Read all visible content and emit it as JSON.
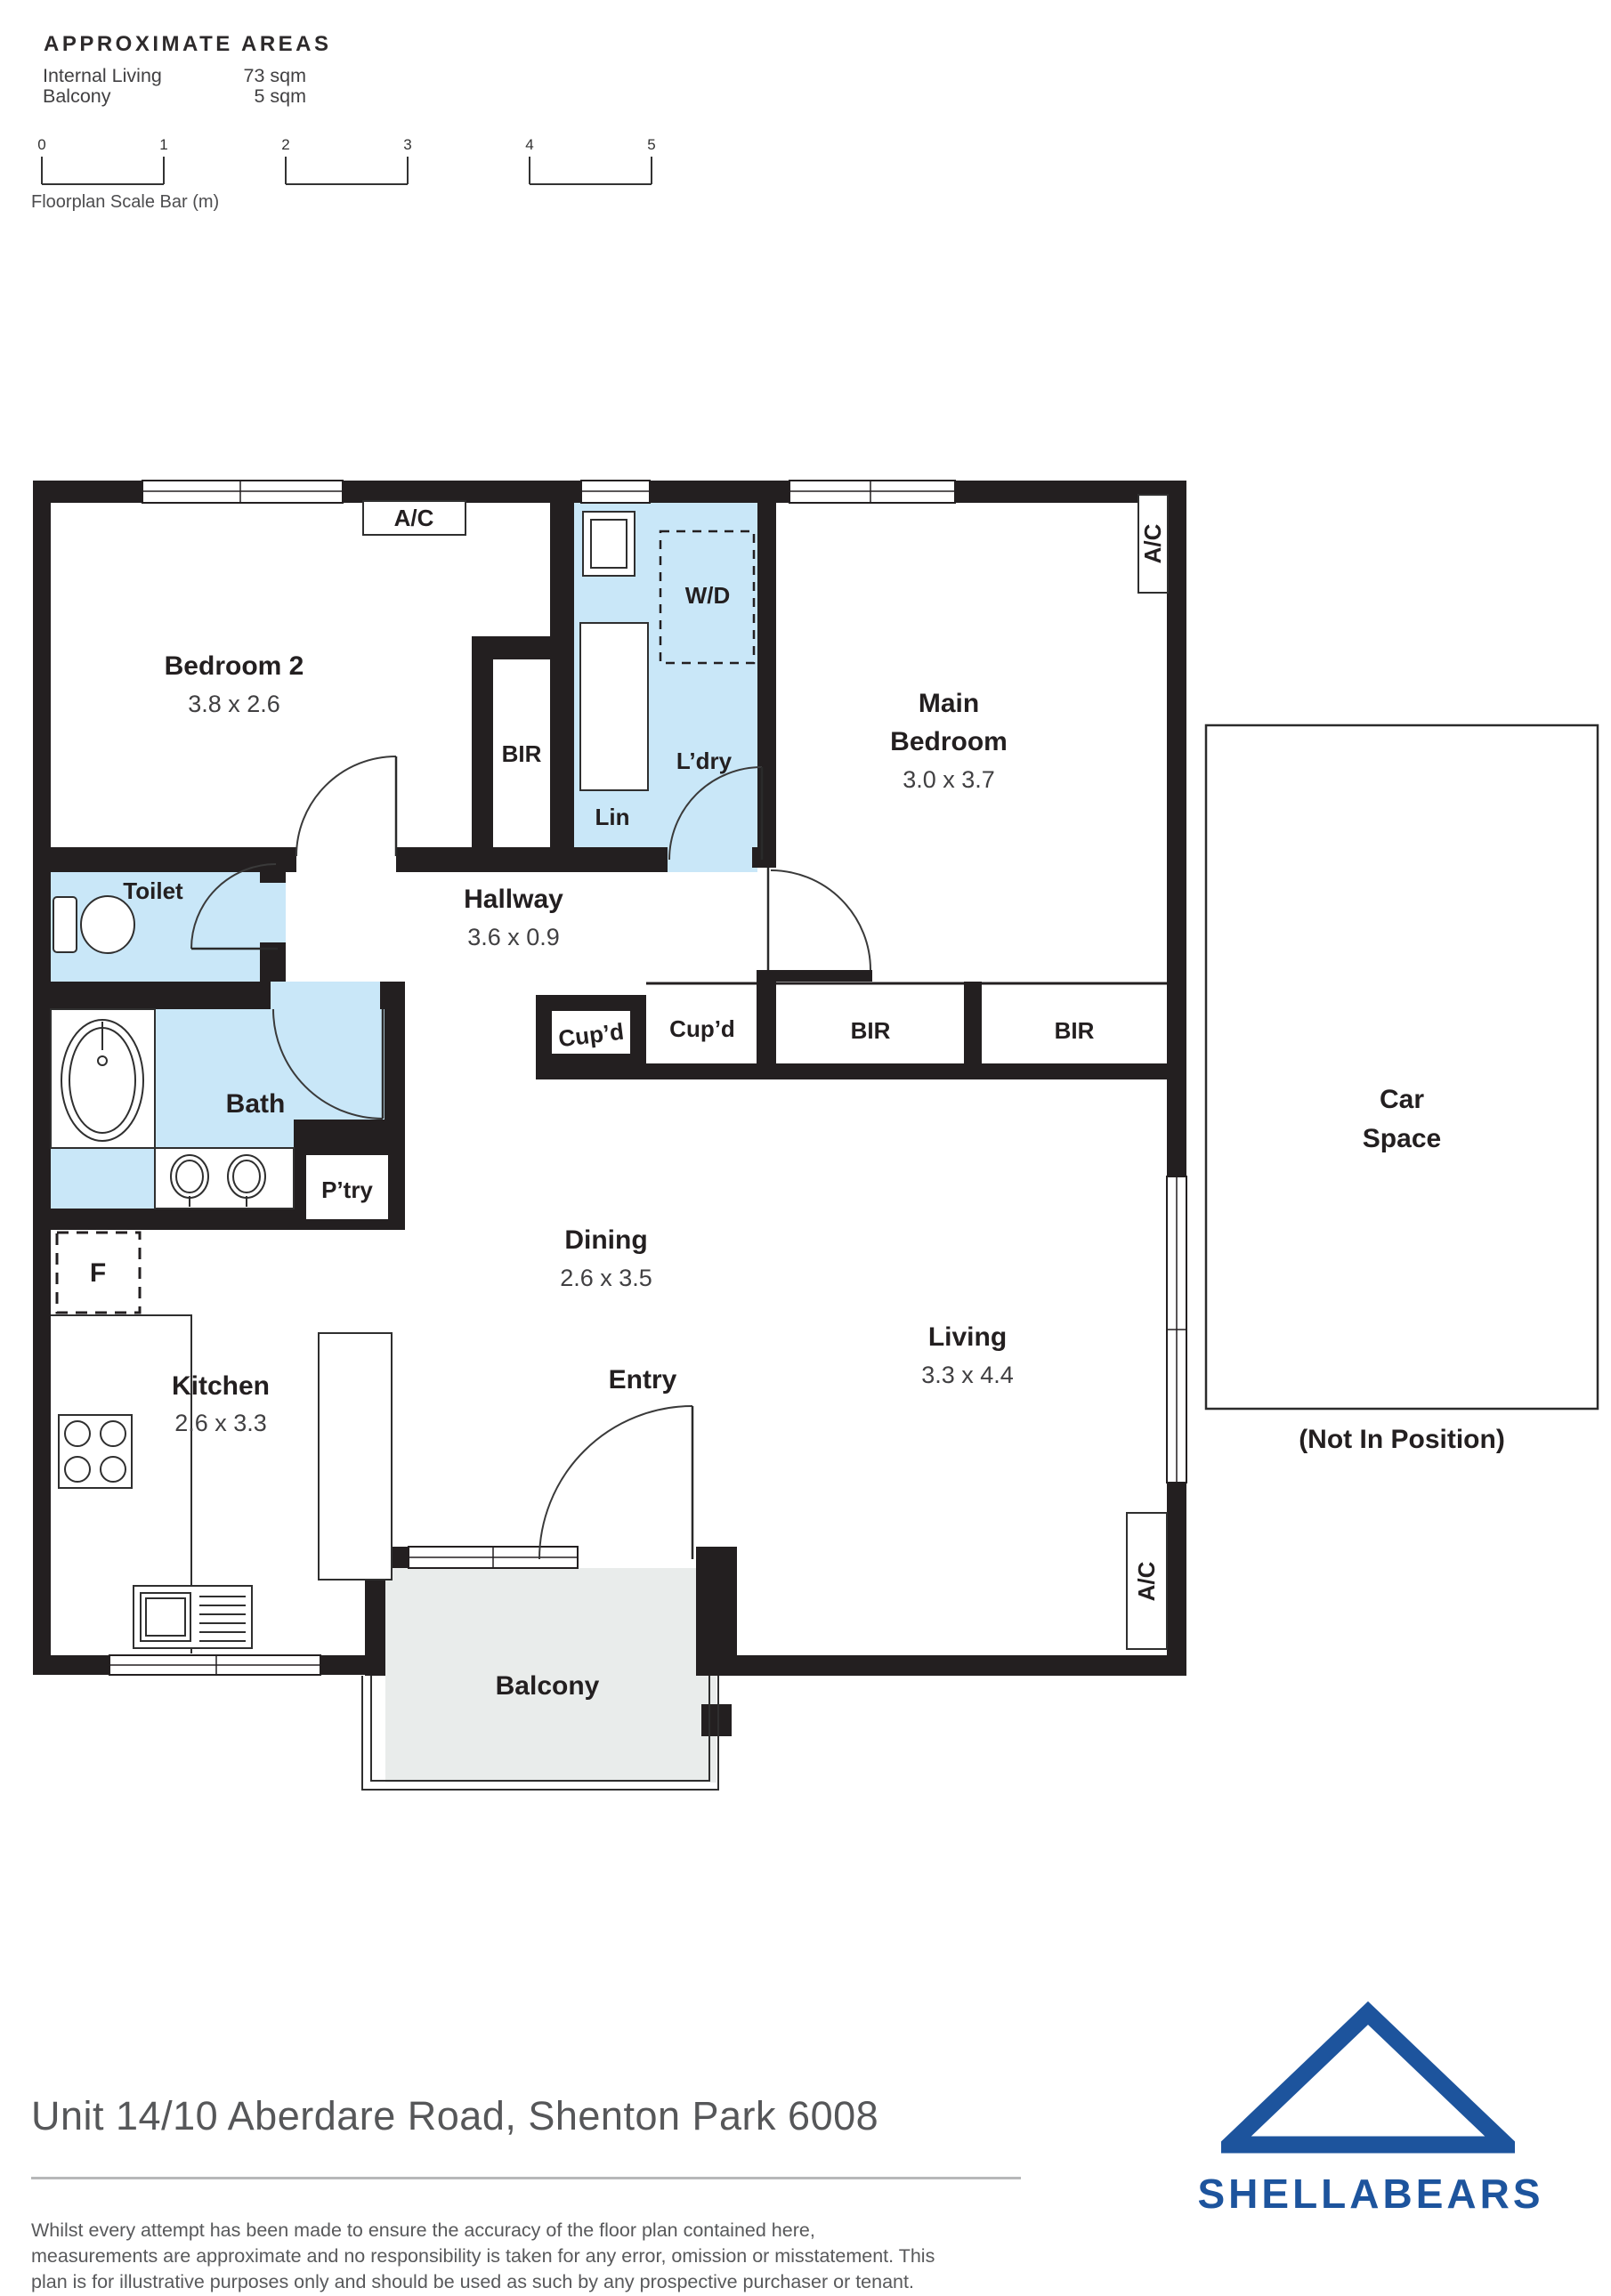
{
  "approximate_areas": {
    "title": "APPROXIMATE AREAS",
    "rows": [
      {
        "label": "Internal Living",
        "value": "73 sqm"
      },
      {
        "label": "Balcony",
        "value": "5 sqm"
      }
    ]
  },
  "scale_bar": {
    "labels": [
      "0",
      "1",
      "2",
      "3",
      "4",
      "5"
    ],
    "caption": "Floorplan Scale Bar (m)"
  },
  "floorplan": {
    "bedroom2": {
      "name": "Bedroom 2",
      "dims": "3.8 x 2.6",
      "bir": "BIR",
      "ac": "A/C"
    },
    "laundry": {
      "name": "L’dry",
      "wd": "W/D",
      "lin": "Lin"
    },
    "main_bedroom": {
      "name_line1": "Main",
      "name_line2": "Bedroom",
      "dims": "3.0 x 3.7",
      "ac": "A/C"
    },
    "toilet": {
      "name": "Toilet"
    },
    "hallway": {
      "name": "Hallway",
      "dims": "3.6 x 0.9"
    },
    "bath": {
      "name": "Bath"
    },
    "pantry": {
      "name": "P’try"
    },
    "storage": {
      "cupd_small": "Cup’d",
      "cupd": "Cup’d",
      "bir_left": "BIR",
      "bir_right": "BIR"
    },
    "kitchen": {
      "name": "Kitchen",
      "dims": "2.6 x 3.3",
      "fridge": "F"
    },
    "dining": {
      "name": "Dining",
      "dims": "2.6 x 3.5"
    },
    "entry": {
      "name": "Entry"
    },
    "living": {
      "name": "Living",
      "dims": "3.3 x 4.4",
      "ac": "A/C"
    },
    "balcony": {
      "name": "Balcony"
    },
    "car_space": {
      "name_line1": "Car",
      "name_line2": "Space",
      "note": "(Not In Position)"
    }
  },
  "footer": {
    "address": "Unit 14/10 Aberdare Road, Shenton Park 6008",
    "disclaimer": "Whilst every attempt has been made to ensure the accuracy of the floor plan contained here, measurements are approximate and no responsibility is taken for any error, omission or misstatement. This plan is for illustrative purposes only and should be used as such by any prospective purchaser or tenant.",
    "brand": "SHELLABEARS"
  },
  "colors": {
    "wall": "#231f20",
    "wet_area": "#c9e7f8",
    "balcony_floor": "#e9eceb",
    "brand_blue": "#1d549d"
  }
}
